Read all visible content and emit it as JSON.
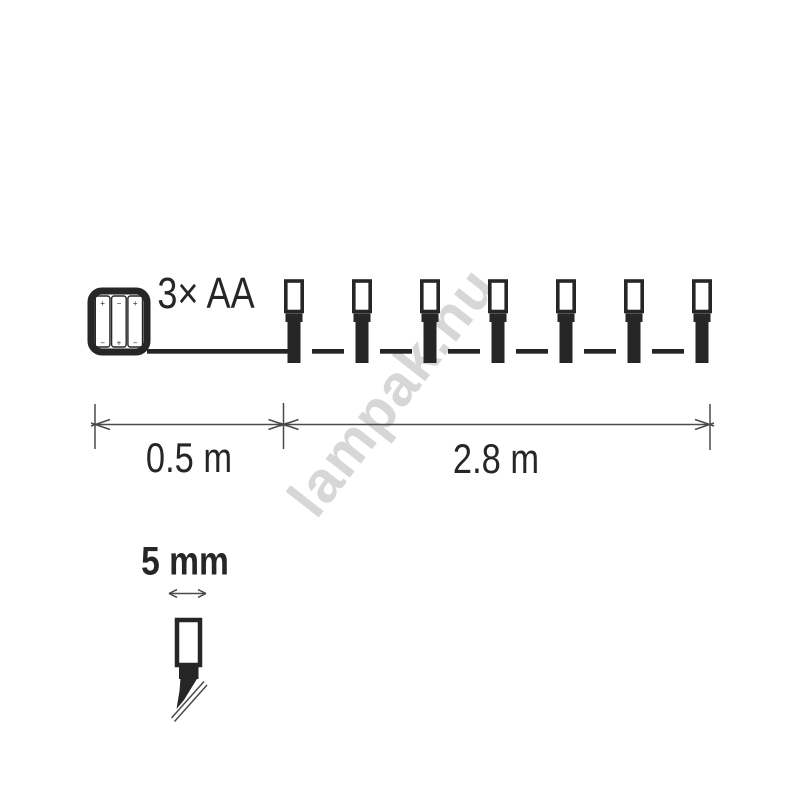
{
  "watermark": {
    "text": "lampak.hu"
  },
  "diagram": {
    "battery_box": {
      "label": "3× AA",
      "battery_count": 3,
      "battery_polarity_top": [
        "+",
        "−",
        "+"
      ],
      "battery_polarity_bottom": [
        "−",
        "+",
        "−"
      ]
    },
    "light_string": {
      "led_count": 7
    },
    "dimensions": {
      "lead_length_label": "0.5 m",
      "string_length_label": "2.8 m"
    },
    "led_detail": {
      "size_label": "5 mm"
    }
  },
  "colors": {
    "shape": "#262626",
    "dimension_line": "#4a4a4a",
    "text": "#262626",
    "watermark": "#d7d7d7",
    "background": "#ffffff"
  }
}
